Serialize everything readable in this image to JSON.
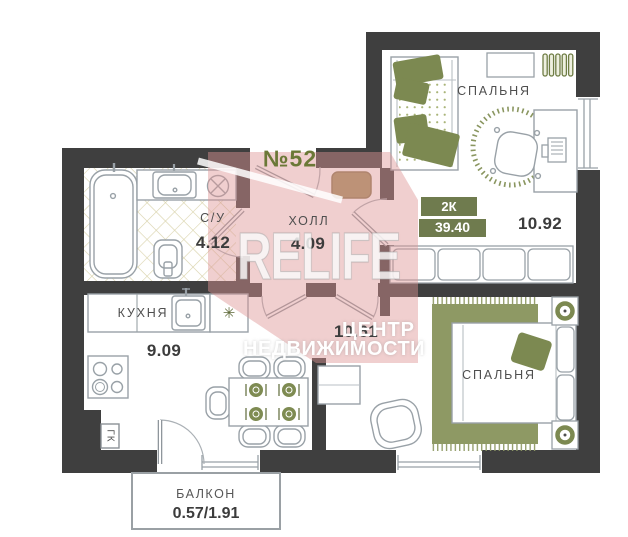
{
  "apartment": {
    "number": "№52",
    "rooms_type": "2К",
    "total_area": "39.40"
  },
  "rooms": {
    "bathroom": {
      "name": "С/У",
      "area": "4.12"
    },
    "hall": {
      "name": "ХОЛЛ",
      "area": "4.09"
    },
    "bedroom_top": {
      "name": "СПАЛЬНЯ",
      "area": "10.92"
    },
    "kitchen": {
      "name": "КУХНЯ",
      "area": "9.09"
    },
    "bedroom_bottom": {
      "name": "СПАЛЬНЯ",
      "area": "10.61"
    },
    "balcony": {
      "name": "БАЛКОН",
      "area": "0.57/1.91"
    }
  },
  "annotations": {
    "wardrobe_niche": "ГК",
    "fridge_symbol": "✳"
  },
  "watermark": {
    "brand": "RELIFE",
    "line1": "ЦЕНТР",
    "line2": "НЕДВИЖИМОСТИ"
  },
  "colors": {
    "wall": "#3f3f3f",
    "furniture_line": "#99a1a7",
    "accent_olive": "#7c8951",
    "rug_olive": "#8e9964",
    "badge_olive": "#6f7b4e",
    "number_green": "#6b7837",
    "doormat_tan": "#a3905f",
    "tile_line": "#d9d3ab",
    "watermark_pink": "rgba(222,148,148,0.45)"
  }
}
